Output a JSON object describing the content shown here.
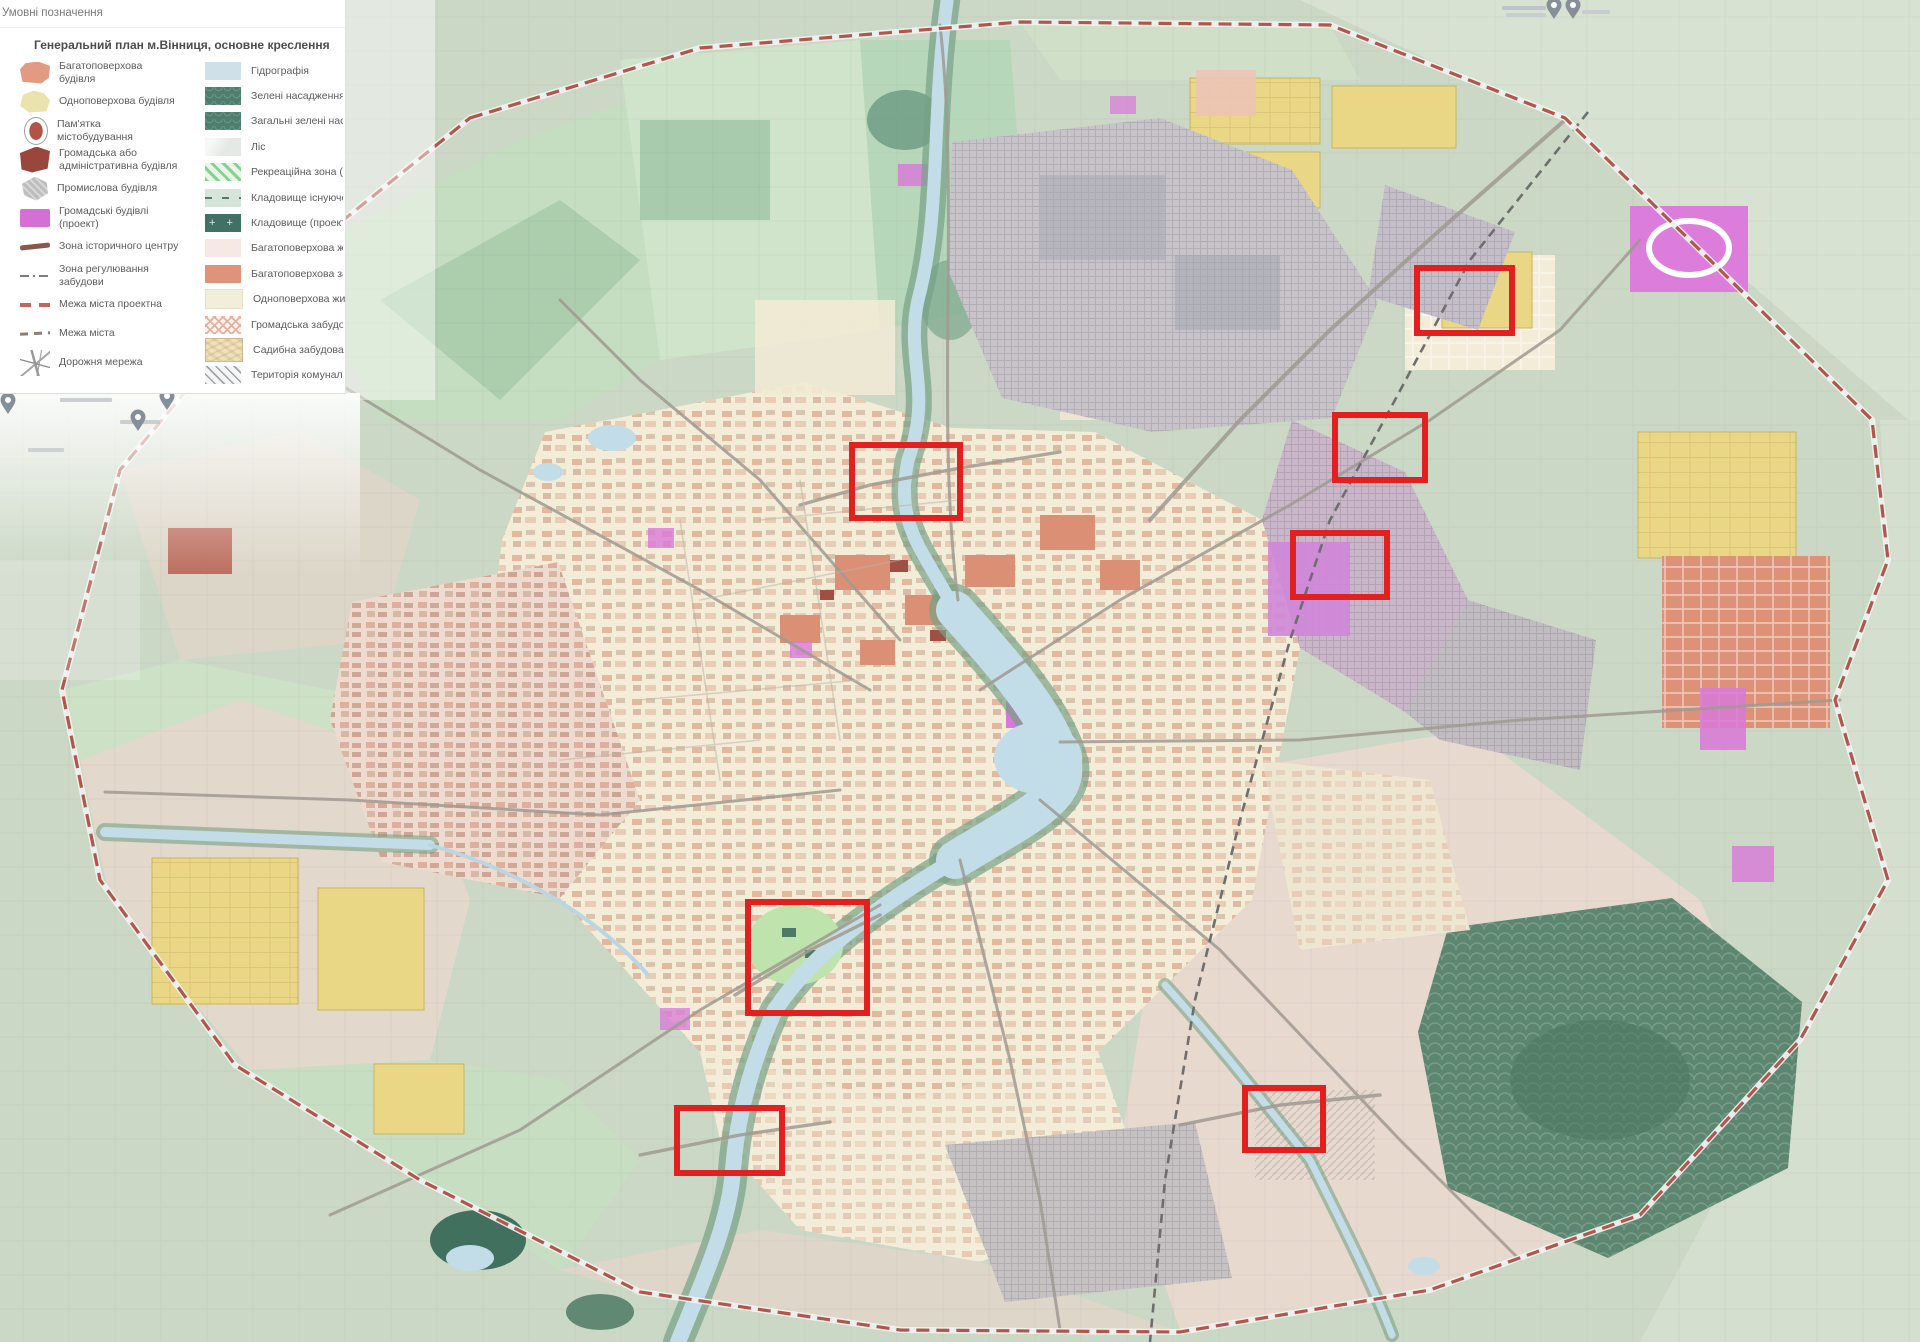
{
  "legend": {
    "header": "Умовні позначення",
    "title": "Генеральний план м.Вінниця, основне креслення",
    "left_items": [
      {
        "label": "Багатоповерхова будівля",
        "swatch": "bldg-salmon"
      },
      {
        "label": "Одноповерхова будівля",
        "swatch": "bldg-cream"
      },
      {
        "label": "Пам'ятка містобудування",
        "swatch": "monument"
      },
      {
        "label": "Громадська або адміністративна будівля",
        "swatch": "bldg-maroon"
      },
      {
        "label": "Промислова будівля",
        "swatch": "bldg-industrial"
      },
      {
        "label": "Громадські будівлі (проект)",
        "swatch": "rect-magenta"
      },
      {
        "label": "Зона історичного центру",
        "swatch": "line-historic"
      },
      {
        "label": "Зона регулювання забудови",
        "swatch": "line-dashdot"
      },
      {
        "label": "Межа міста проектна",
        "swatch": "line-dash-red"
      },
      {
        "label": "Межа міста",
        "swatch": "line-dash-gray"
      },
      {
        "label": "Дорожня мережа",
        "swatch": "roads"
      }
    ],
    "right_items": [
      {
        "label": "Гідрографія",
        "swatch": "water"
      },
      {
        "label": "Зелені насадження (проект)",
        "swatch": "green-project"
      },
      {
        "label": "Загальні зелені насадження",
        "swatch": "green-common"
      },
      {
        "label": "Ліс",
        "swatch": "forest"
      },
      {
        "label": "Рекреаційна зона (1)",
        "swatch": "recreation"
      },
      {
        "label": "Кладовище існуюче",
        "swatch": "cemetery-existing"
      },
      {
        "label": "Кладовище (проект)",
        "swatch": "cemetery-project"
      },
      {
        "label": "Багатоповерхова житлова забудова",
        "swatch": "rect-palepink"
      },
      {
        "label": "Багатоповерхова забудова (проект)",
        "swatch": "rect-salmon"
      },
      {
        "label": "Одноповерхова житлова забудова",
        "swatch": "rect-cream"
      },
      {
        "label": "Громадська забудова",
        "swatch": "crosshatch-pink"
      },
      {
        "label": "Садибна забудова (проект)",
        "swatch": "sadybna"
      },
      {
        "label": "Територія комунальна",
        "swatch": "hatch-communal"
      }
    ]
  },
  "highlights": {
    "color": "#e32020",
    "stroke_width": 6,
    "boxes": [
      {
        "x": 1417,
        "y": 268,
        "w": 95,
        "h": 65
      },
      {
        "x": 1335,
        "y": 415,
        "w": 90,
        "h": 65
      },
      {
        "x": 852,
        "y": 445,
        "w": 108,
        "h": 73
      },
      {
        "x": 1293,
        "y": 533,
        "w": 94,
        "h": 64
      },
      {
        "x": 748,
        "y": 902,
        "w": 119,
        "h": 111
      },
      {
        "x": 677,
        "y": 1108,
        "w": 105,
        "h": 65
      },
      {
        "x": 1245,
        "y": 1088,
        "w": 78,
        "h": 62
      }
    ]
  },
  "map_pins": [
    {
      "x": 1554,
      "y": 19
    },
    {
      "x": 1573,
      "y": 19
    },
    {
      "x": 8,
      "y": 414
    },
    {
      "x": 138,
      "y": 431
    },
    {
      "x": 167,
      "y": 410
    }
  ],
  "palette": {
    "background": "#ccd8c6",
    "water": "#c3dde8",
    "forest_dark": "#5c866f",
    "urban_cream": "#f3edd8",
    "multistorey_salmon": "#dd9176",
    "public_magenta": "#d878d8",
    "industrial_gray": "#c7c3c9",
    "low_rise_yellow": "#e9d786",
    "boundary_red": "#b0564c",
    "highlight_red": "#e32020"
  }
}
